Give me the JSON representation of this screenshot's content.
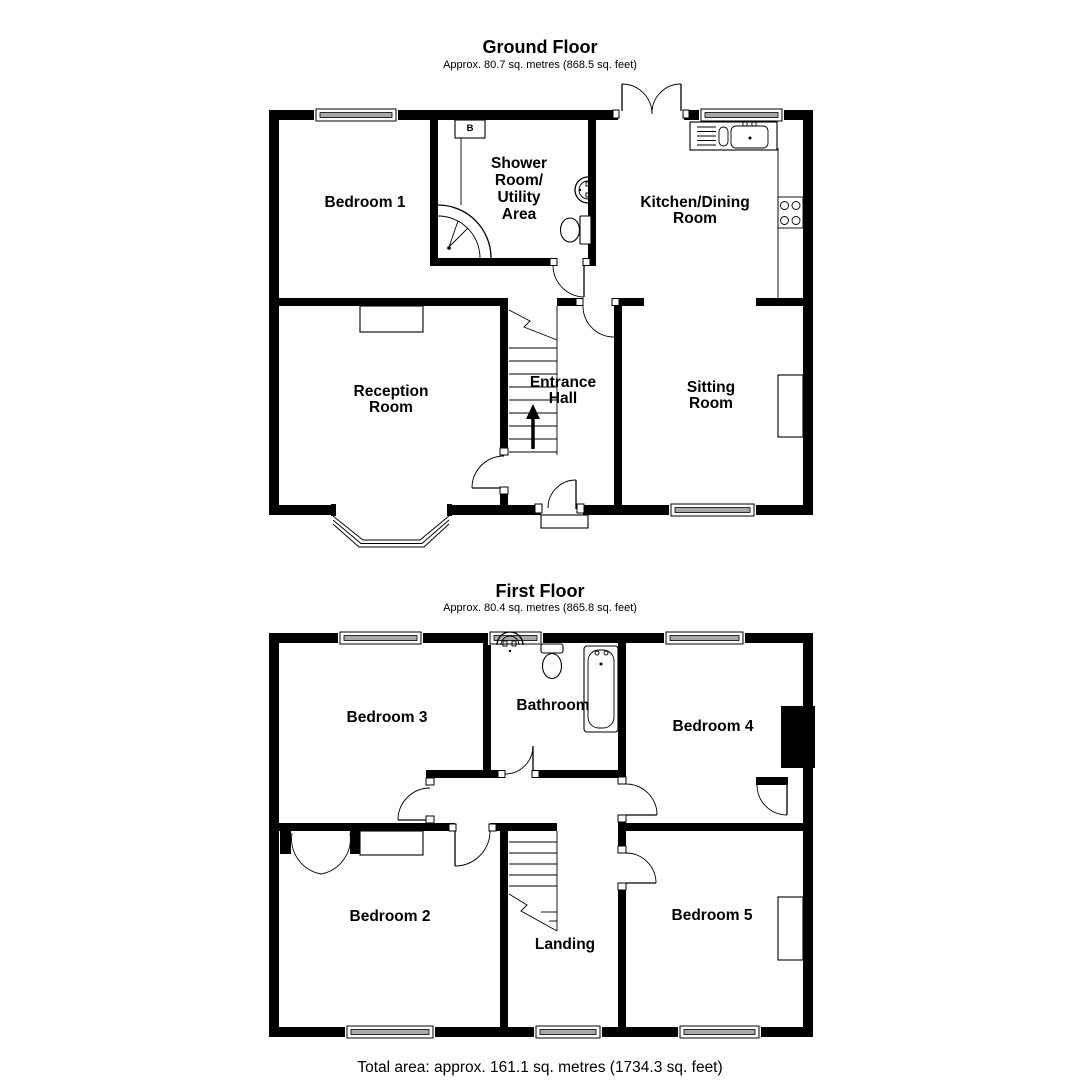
{
  "colors": {
    "background": "#ffffff",
    "walls": "#000000",
    "text": "#000000",
    "window_fill": "#a8a8a8"
  },
  "ground_floor": {
    "title": "Ground Floor",
    "subtitle": "Approx. 80.7 sq. metres (868.5 sq. feet)",
    "boiler_label": "B",
    "rooms": {
      "bedroom1": {
        "label": "Bedroom 1"
      },
      "shower_room": {
        "lines": [
          "Shower",
          "Room/",
          "Utility",
          "Area"
        ]
      },
      "kitchen": {
        "lines": [
          "Kitchen/Dining",
          "Room"
        ]
      },
      "reception": {
        "lines": [
          "Reception",
          "Room"
        ]
      },
      "entrance_hall": {
        "lines": [
          "Entrance",
          "Hall"
        ]
      },
      "sitting_room": {
        "lines": [
          "Sitting",
          "Room"
        ]
      }
    }
  },
  "first_floor": {
    "title": "First Floor",
    "subtitle": "Approx. 80.4 sq. metres (865.8 sq. feet)",
    "rooms": {
      "bedroom3": {
        "label": "Bedroom 3"
      },
      "bathroom": {
        "label": "Bathroom"
      },
      "bedroom4": {
        "label": "Bedroom 4"
      },
      "bedroom2": {
        "label": "Bedroom 2"
      },
      "landing": {
        "label": "Landing"
      },
      "bedroom5": {
        "label": "Bedroom 5"
      }
    }
  },
  "footer": {
    "total_area": "Total area: approx. 161.1 sq. metres (1734.3 sq. feet)"
  }
}
